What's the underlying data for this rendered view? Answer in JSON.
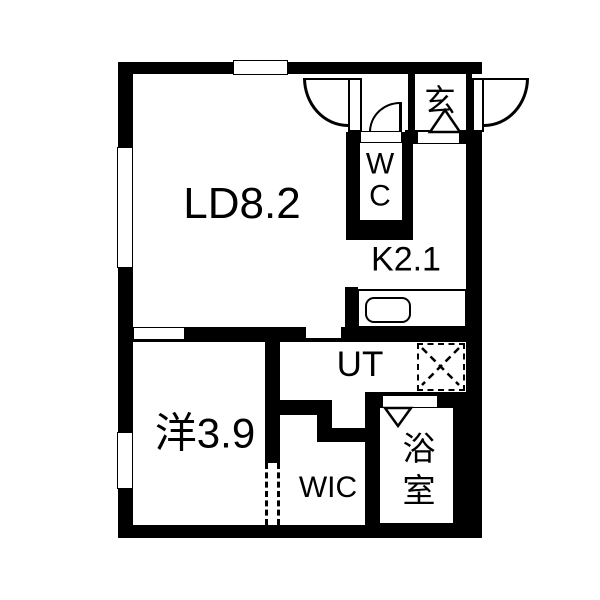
{
  "title": "1LDK apartment floor plan",
  "colors": {
    "wall": "#000000",
    "floor": "#ffffff",
    "line": "#000000"
  },
  "rooms": [
    {
      "id": "living-dining",
      "label": "LD8.2"
    },
    {
      "id": "kitchen",
      "label": "K2.1"
    },
    {
      "id": "toilet",
      "label": "W\nC"
    },
    {
      "id": "entrance",
      "label": "玄"
    },
    {
      "id": "utility",
      "label": "UT"
    },
    {
      "id": "western-room",
      "label": "洋3.9"
    },
    {
      "id": "walk-in-closet",
      "label": "WIC"
    },
    {
      "id": "bathroom",
      "label": "浴\n室"
    }
  ],
  "fixtures": {
    "entrance_double_door": "double swing door with two quarter-circle arcs",
    "wc_door": "quarter-circle swing door",
    "windows": [
      "top-wall window",
      "left-wall upper window",
      "left-wall lower window"
    ],
    "kitchen_counter": "counter with rounded sink",
    "washing_machine_space": "dashed square with X",
    "closet_opening": "dashed open wall between western room and WIC",
    "entrance_step_marker": "triangle marker",
    "bathroom_door_marker": "triangle marker"
  }
}
